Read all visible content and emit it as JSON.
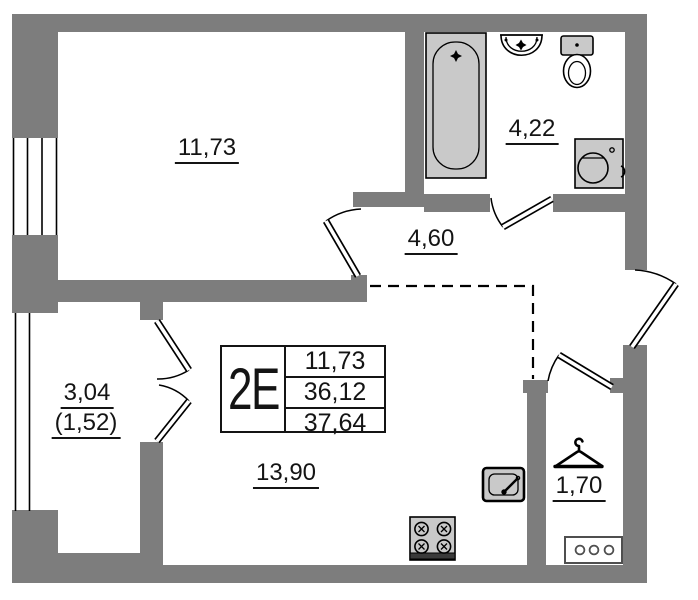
{
  "plan": {
    "unit_code": "2E",
    "info_table": {
      "unit_code": "2E",
      "rows": [
        "11,73",
        "36,12",
        "37,64"
      ]
    },
    "rooms": [
      {
        "name": "room-upper",
        "area": "11,73"
      },
      {
        "name": "bathroom",
        "area": "4,22"
      },
      {
        "name": "hallway",
        "area": "4,60"
      },
      {
        "name": "balcony",
        "area": "3,04",
        "reduced_area": "(1,52)"
      },
      {
        "name": "kitchen-living-room",
        "area": "13,90"
      },
      {
        "name": "wardrobe",
        "area": "1,70"
      }
    ],
    "fixtures": [
      "bathtub",
      "wash-basin",
      "toilet",
      "washing-machine",
      "kitchen-sink",
      "stove-4-burner",
      "clothes-hanger",
      "cabinet-3-knobs"
    ],
    "colors": {
      "wall": "#7d7d7d",
      "fixture": "#c9c9c9",
      "line": "#000000",
      "bg": "#ffffff",
      "dark": "#3a3a3a",
      "cab": "#4f4f4f"
    }
  }
}
